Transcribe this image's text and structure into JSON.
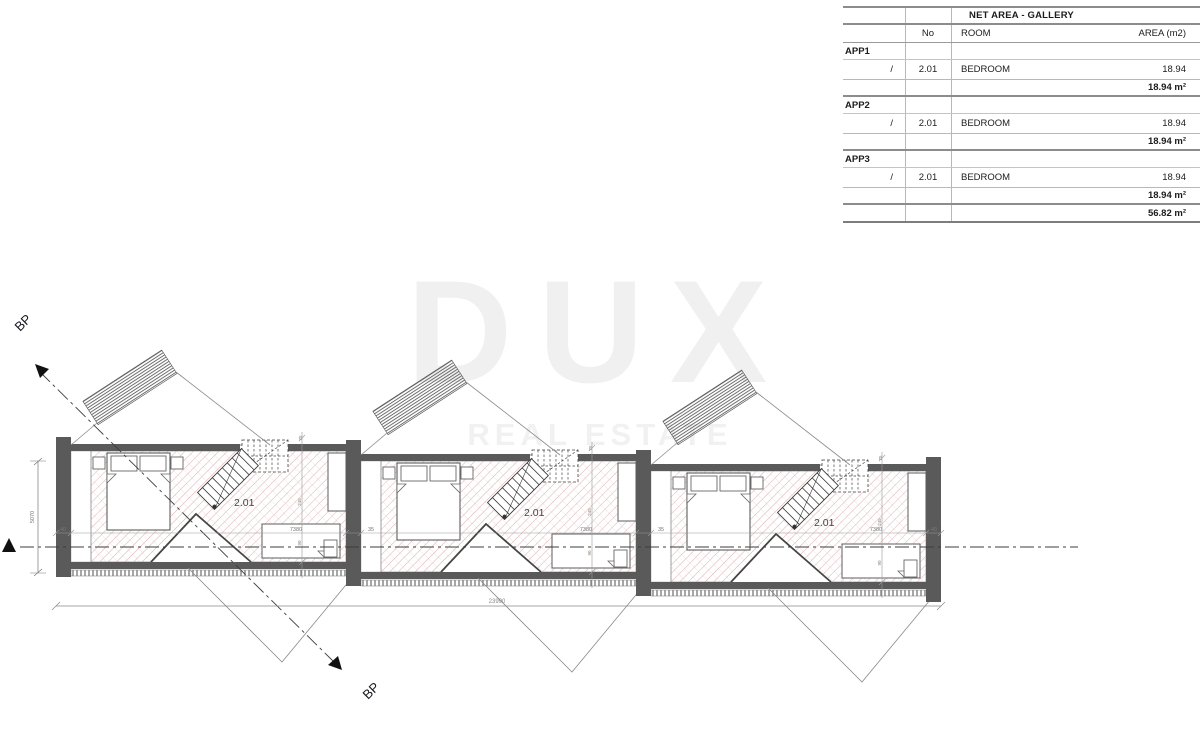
{
  "table": {
    "title": "NET AREA - GALLERY",
    "columns": {
      "no": "No",
      "room": "ROOM",
      "area": "AREA (m2)"
    },
    "apps": [
      {
        "name": "APP1",
        "slash": "/",
        "no": "2.01",
        "room": "BEDROOM",
        "area": "18.94",
        "subtotal": "18.94 m²"
      },
      {
        "name": "APP2",
        "slash": "/",
        "no": "2.01",
        "room": "BEDROOM",
        "area": "18.94",
        "subtotal": "18.94 m²"
      },
      {
        "name": "APP3",
        "slash": "/",
        "no": "2.01",
        "room": "BEDROOM",
        "area": "18.94",
        "subtotal": "18.94 m²"
      }
    ],
    "total": "56.82 m²"
  },
  "plan": {
    "room_label": "2.01",
    "section_label": "BP",
    "dims": {
      "total_width": "23990",
      "unit_width": "7380",
      "wall_left": "40",
      "wall_mid": "35",
      "depth": "5070",
      "d1": "75",
      "d2": "245",
      "d3": "90"
    }
  },
  "watermark": {
    "line1": "DUX",
    "line2": "REAL ESTATE"
  },
  "colors": {
    "wall": "#5a5a5a",
    "hatch_pink": "#d8a8a8",
    "line_gray": "#8a8a8a",
    "watermark_gray": "#f0f0f0",
    "table_rule": "#8c8c8c"
  }
}
